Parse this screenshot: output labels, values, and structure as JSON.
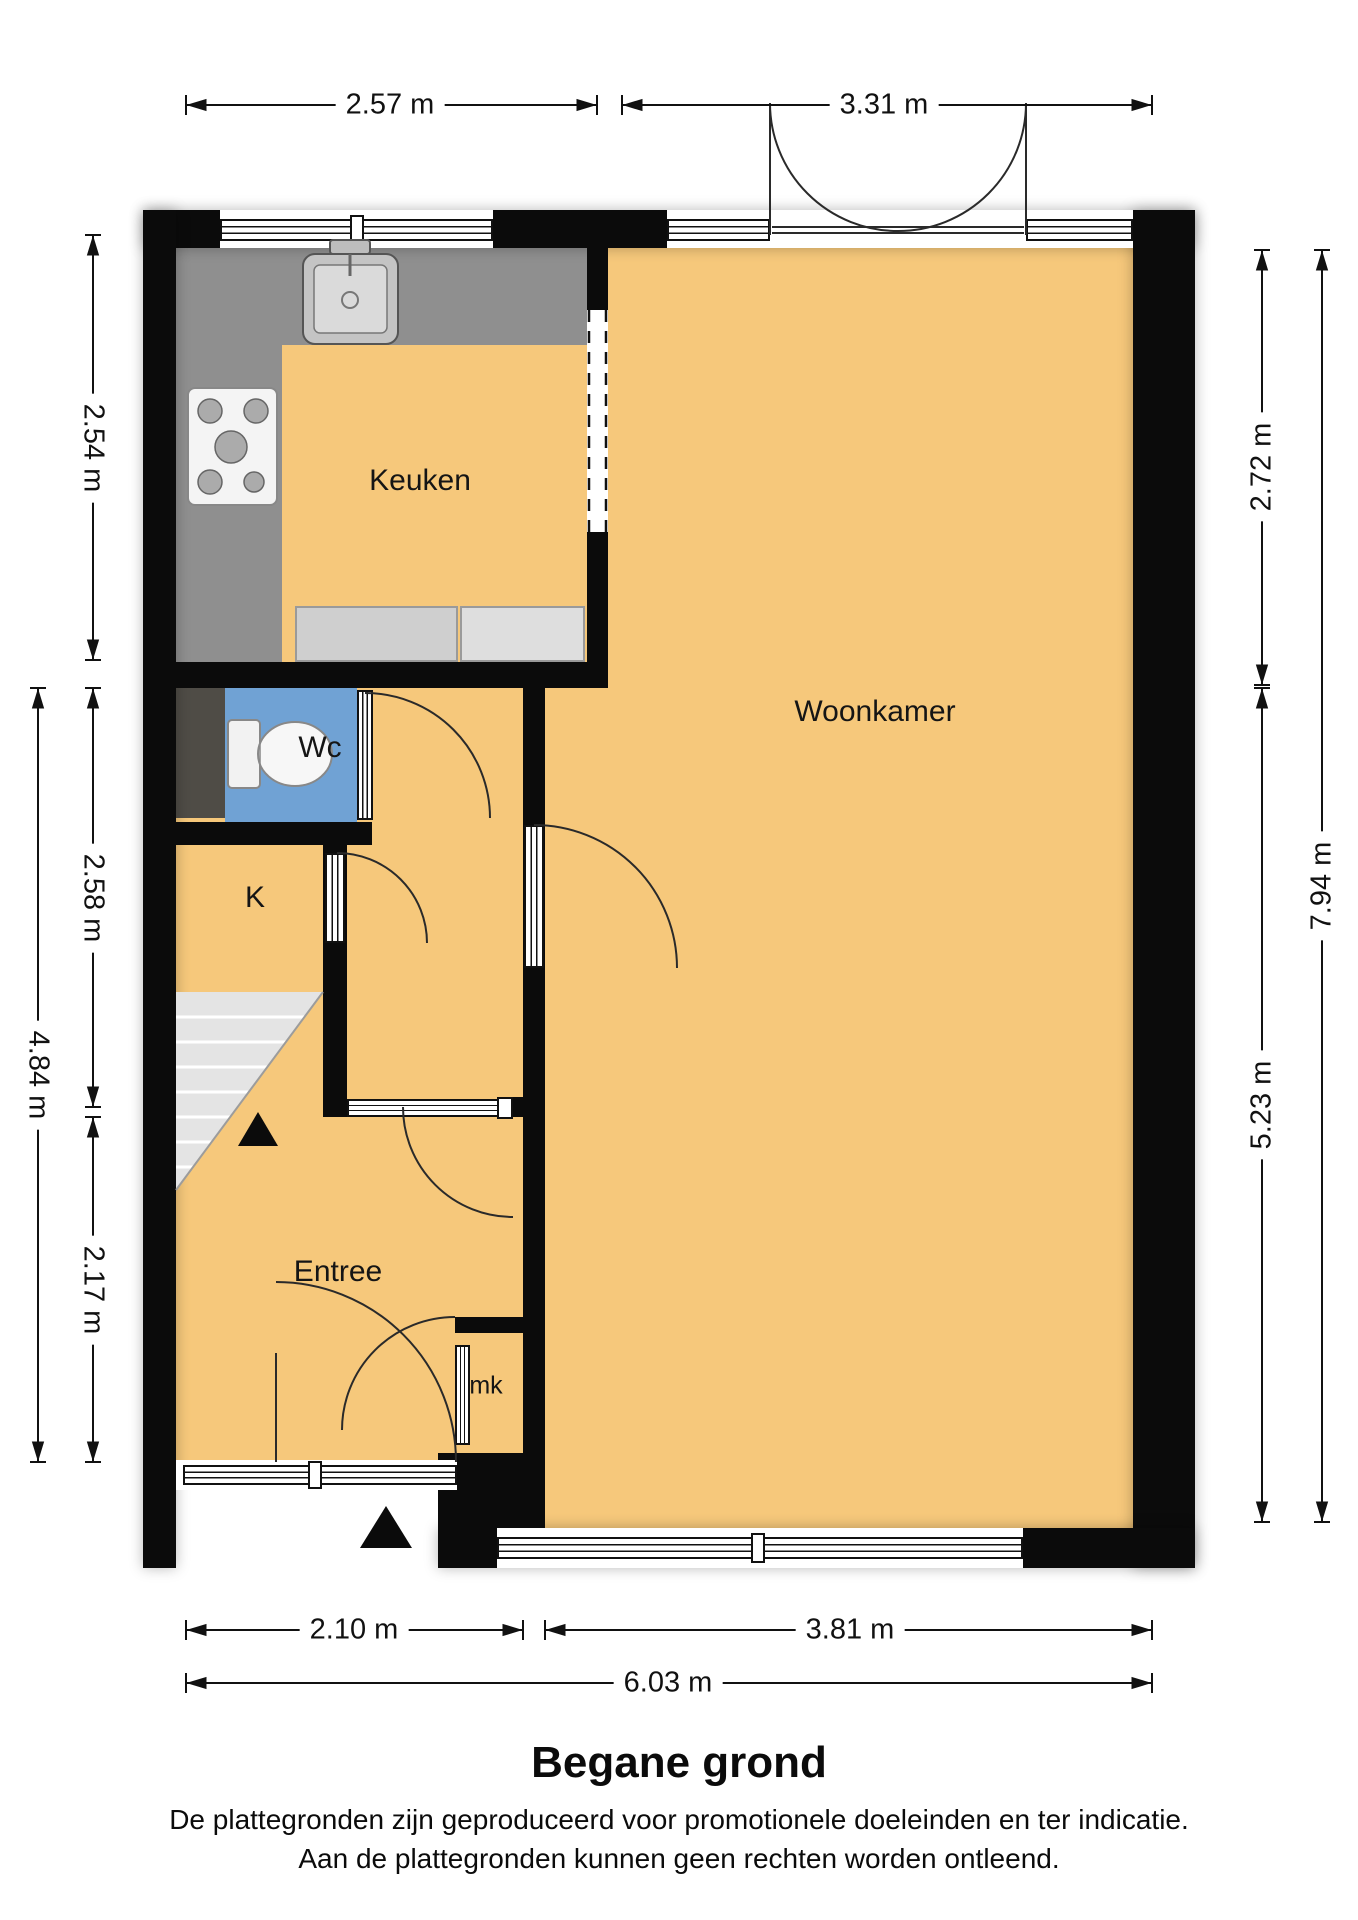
{
  "title": "Begane grond",
  "footer": {
    "line1": "De plattegronden zijn geproduceerd voor promotionele doeleinden en ter indicatie.",
    "line2": "Aan de plattegronden kunnen geen rechten worden ontleend."
  },
  "rooms": {
    "keuken": "Keuken",
    "wc": "Wc",
    "k": "K",
    "woonkamer": "Woonkamer",
    "entree": "Entree",
    "mk": "mk"
  },
  "dimensions": {
    "top": [
      {
        "label": "2.57 m"
      },
      {
        "label": "3.31 m"
      }
    ],
    "bottom": [
      {
        "label": "2.10 m"
      },
      {
        "label": "3.81 m"
      },
      {
        "label": "6.03 m"
      }
    ],
    "left": [
      {
        "label": "2.54 m"
      },
      {
        "label": "2.58 m"
      },
      {
        "label": "2.17 m"
      },
      {
        "label": "4.84 m"
      }
    ],
    "right": [
      {
        "label": "2.72 m"
      },
      {
        "label": "5.23 m"
      },
      {
        "label": "7.94 m"
      }
    ]
  },
  "colors": {
    "floor": "#F6C87B",
    "wall": "#0B0B0B",
    "wc_floor": "#70A2D4",
    "counter": "#8F8F8F",
    "stairs": "#E4E4E4"
  }
}
